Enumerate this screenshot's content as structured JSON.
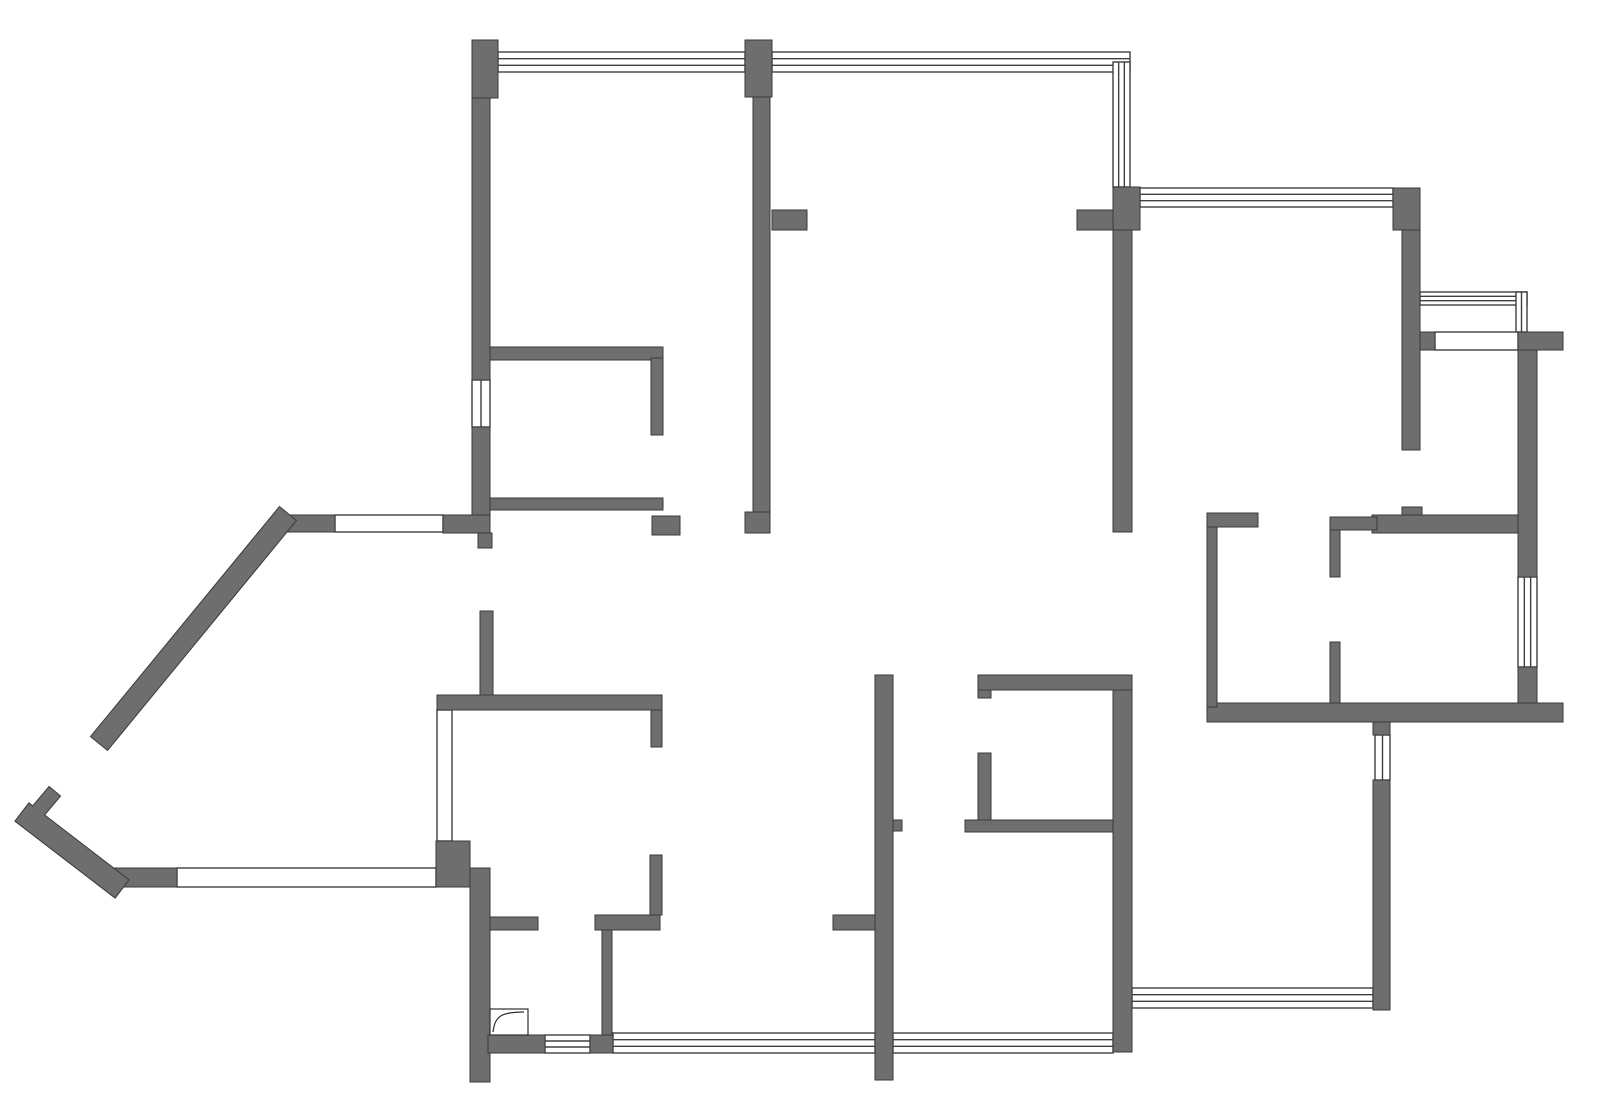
{
  "floor_plan": {
    "canvas": {
      "width": 1600,
      "height": 1109,
      "background": "#ffffff"
    },
    "colors": {
      "wall_fill": "#6e6e6e",
      "wall_stroke": "#3a3a3a",
      "window_stroke": "#3f3f3f",
      "window_fill": "#ffffff",
      "door_stroke": "#2f2f2f"
    },
    "walls": [
      [
        472,
        40,
        26,
        58
      ],
      [
        472,
        98,
        18,
        282
      ],
      [
        472,
        427,
        18,
        106
      ],
      [
        745,
        40,
        27,
        57
      ],
      [
        753,
        97,
        17,
        415
      ],
      [
        745,
        512,
        25,
        21
      ],
      [
        772,
        210,
        35,
        20
      ],
      [
        1077,
        210,
        36,
        20
      ],
      [
        1113,
        187,
        27,
        43
      ],
      [
        1113,
        230,
        19,
        302
      ],
      [
        1393,
        188,
        27,
        42
      ],
      [
        1402,
        230,
        18,
        220
      ],
      [
        1402,
        507,
        20,
        10
      ],
      [
        1372,
        515,
        146,
        18
      ],
      [
        1420,
        332,
        15,
        18
      ],
      [
        1518,
        332,
        45,
        18
      ],
      [
        1518,
        350,
        19,
        227
      ],
      [
        1518,
        667,
        19,
        36
      ],
      [
        1207,
        703,
        356,
        19
      ],
      [
        1330,
        517,
        47,
        13
      ],
      [
        1330,
        530,
        10,
        47
      ],
      [
        1330,
        642,
        10,
        61
      ],
      [
        1207,
        513,
        51,
        14
      ],
      [
        1207,
        527,
        10,
        180
      ],
      [
        490,
        347,
        173,
        13
      ],
      [
        651,
        358,
        12,
        77
      ],
      [
        490,
        498,
        173,
        12
      ],
      [
        652,
        516,
        28,
        19
      ],
      [
        273,
        515,
        62,
        17
      ],
      [
        443,
        515,
        47,
        18
      ],
      [
        478,
        533,
        14,
        15
      ],
      [
        480,
        611,
        13,
        84
      ],
      [
        437,
        695,
        225,
        15
      ],
      [
        651,
        710,
        11,
        37
      ],
      [
        650,
        855,
        12,
        60
      ],
      [
        595,
        915,
        65,
        15
      ],
      [
        602,
        930,
        10,
        105
      ],
      [
        436,
        841,
        34,
        46
      ],
      [
        110,
        868,
        67,
        19
      ],
      [
        470,
        868,
        20,
        214
      ],
      [
        490,
        917,
        48,
        13
      ],
      [
        488,
        1035,
        57,
        18
      ],
      [
        590,
        1035,
        23,
        18
      ],
      [
        875,
        675,
        18,
        405
      ],
      [
        893,
        820,
        9,
        11
      ],
      [
        833,
        915,
        42,
        15
      ],
      [
        978,
        675,
        13,
        23
      ],
      [
        978,
        675,
        154,
        15
      ],
      [
        978,
        753,
        13,
        67
      ],
      [
        965,
        820,
        148,
        12
      ],
      [
        1113,
        690,
        19,
        362
      ],
      [
        1373,
        722,
        17,
        13
      ],
      [
        1373,
        780,
        17,
        230
      ]
    ],
    "diagonal_walls": [
      {
        "x1": 281,
        "y1": 522,
        "x2": 106,
        "y2": 735,
        "w": 21
      },
      {
        "x1": 31,
        "y1": 819,
        "x2": 113,
        "y2": 882,
        "w": 22
      },
      {
        "x1": 34,
        "y1": 816,
        "x2": 50,
        "y2": 797,
        "w": 14
      }
    ],
    "windows": [
      {
        "x": 498,
        "y": 52,
        "w": 247,
        "h": 20,
        "orient": "h",
        "lines": 4
      },
      {
        "x": 772,
        "y": 52,
        "w": 358,
        "h": 20,
        "orient": "h",
        "lines": 4
      },
      {
        "x": 1113,
        "y": 62,
        "w": 17,
        "h": 125,
        "orient": "v",
        "lines": 4
      },
      {
        "x": 1140,
        "y": 188,
        "w": 253,
        "h": 19,
        "orient": "h",
        "lines": 4
      },
      {
        "x": 1420,
        "y": 292,
        "w": 107,
        "h": 13,
        "orient": "h",
        "lines": 4
      },
      {
        "x": 1516,
        "y": 292,
        "w": 11,
        "h": 40,
        "orient": "v",
        "lines": 3
      },
      {
        "x": 1435,
        "y": 332,
        "w": 83,
        "h": 18,
        "orient": "h",
        "lines": 2
      },
      {
        "x": 1518,
        "y": 577,
        "w": 19,
        "h": 90,
        "orient": "v",
        "lines": 4
      },
      {
        "x": 472,
        "y": 380,
        "w": 18,
        "h": 47,
        "orient": "v",
        "lines": 3
      },
      {
        "x": 335,
        "y": 515,
        "w": 108,
        "h": 17,
        "orient": "h",
        "lines": 2
      },
      {
        "x": 437,
        "y": 710,
        "w": 15,
        "h": 131,
        "orient": "v",
        "lines": 2
      },
      {
        "x": 177,
        "y": 868,
        "w": 259,
        "h": 19,
        "orient": "h",
        "lines": 2
      },
      {
        "x": 545,
        "y": 1035,
        "w": 45,
        "h": 18,
        "orient": "h",
        "lines": 4
      },
      {
        "x": 613,
        "y": 1033,
        "w": 262,
        "h": 20,
        "orient": "h",
        "lines": 4
      },
      {
        "x": 893,
        "y": 1033,
        "w": 220,
        "h": 20,
        "orient": "h",
        "lines": 4
      },
      {
        "x": 1132,
        "y": 988,
        "w": 241,
        "h": 20,
        "orient": "h",
        "lines": 4
      },
      {
        "x": 1375,
        "y": 735,
        "w": 15,
        "h": 45,
        "orient": "v",
        "lines": 3
      }
    ],
    "doors": [
      {
        "frame": [
          490,
          1009,
          38,
          26
        ],
        "leaf_path": "M493,1032 C495,1017 500,1012 524,1012"
      }
    ]
  }
}
